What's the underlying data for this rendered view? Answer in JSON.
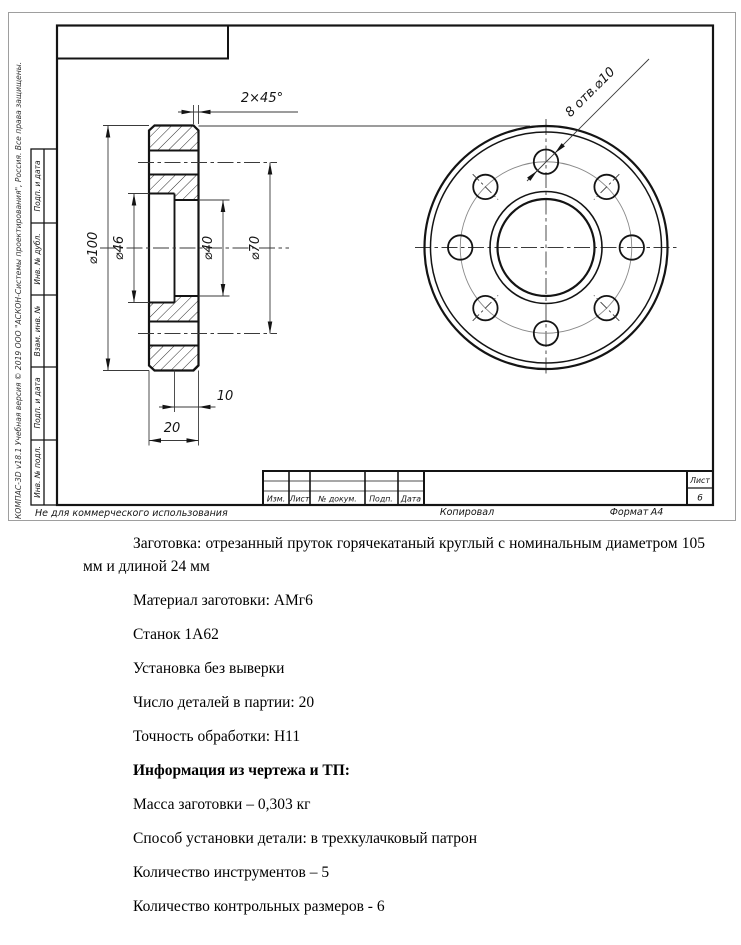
{
  "colors": {
    "line_thick": "#141414",
    "line_thin": "#3a3a3a",
    "line_light": "#8a8a8a",
    "sheet_border": "#9e9e9e"
  },
  "sheet": {
    "watermark": "КОМПАС-3D v18.1 Учебная версия © 2019 ООО \"АСКОН-Системы проектирования\", Россия. Все права защищены.",
    "no_commercial": "Не для коммерческого использования",
    "side_column_labels": [
      "Подп. и дата",
      "Инв. № дубл.",
      "Взам. инв. №",
      "Подп. и дата",
      "Инв. № подл."
    ],
    "title_block": {
      "col_izm": "Изм.",
      "col_list": "Лист",
      "col_doc": "№ докум.",
      "col_podp": "Подп.",
      "col_data": "Дата",
      "sheet_word": "Лист",
      "sheet_no": "6",
      "copied_by": "Копировал",
      "format_word": "Формат",
      "format_value": "А4"
    }
  },
  "dims": {
    "chamfer": "2×45°",
    "d100": "⌀100",
    "d46": "⌀46",
    "d40": "⌀40",
    "d70": "⌀70",
    "holes": "8 отв.⌀10",
    "w10": "10",
    "w20": "20"
  },
  "notes": [
    "Заготовка: отрезанный пруток горячекатаный круглый с номинальным диаметром 105 мм и длиной 24 мм",
    "Материал заготовки: АМг6",
    "Станок 1А62",
    "Установка без выверки",
    "Число деталей в партии: 20",
    "Точность обработки: Н11",
    "Информация из чертежа и ТП:",
    "Масса заготовки – 0,303 кг",
    "Способ установки детали: в трехкулачковый патрон",
    "Количество инструментов – 5",
    "Количество контрольных размеров - 6"
  ]
}
